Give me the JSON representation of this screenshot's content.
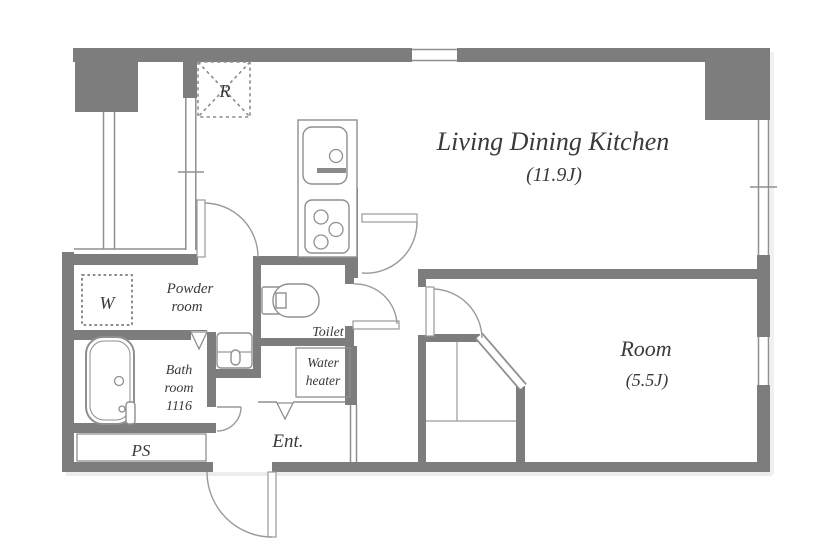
{
  "colors": {
    "wall": "#7d7d7d",
    "thin_line": "#8f8f8f",
    "text": "#3a3a3a",
    "background": "#ffffff"
  },
  "rooms": {
    "ldk": {
      "name": "Living Dining Kitchen",
      "area": "(11.9J)"
    },
    "room": {
      "name": "Room",
      "area": "(5.5J)"
    },
    "powder": {
      "line1": "Powder",
      "line2": "room"
    },
    "toilet": {
      "label": "Toilet"
    },
    "water_heater": {
      "line1": "Water",
      "line2": "heater"
    },
    "bath": {
      "line1": "Bath",
      "line2": "room",
      "line3": "1116"
    },
    "pipe_space": {
      "label": "PS"
    },
    "entrance": {
      "label": "Ent."
    },
    "closet": {
      "label": "W"
    },
    "refrigerator": {
      "label": "R"
    }
  }
}
